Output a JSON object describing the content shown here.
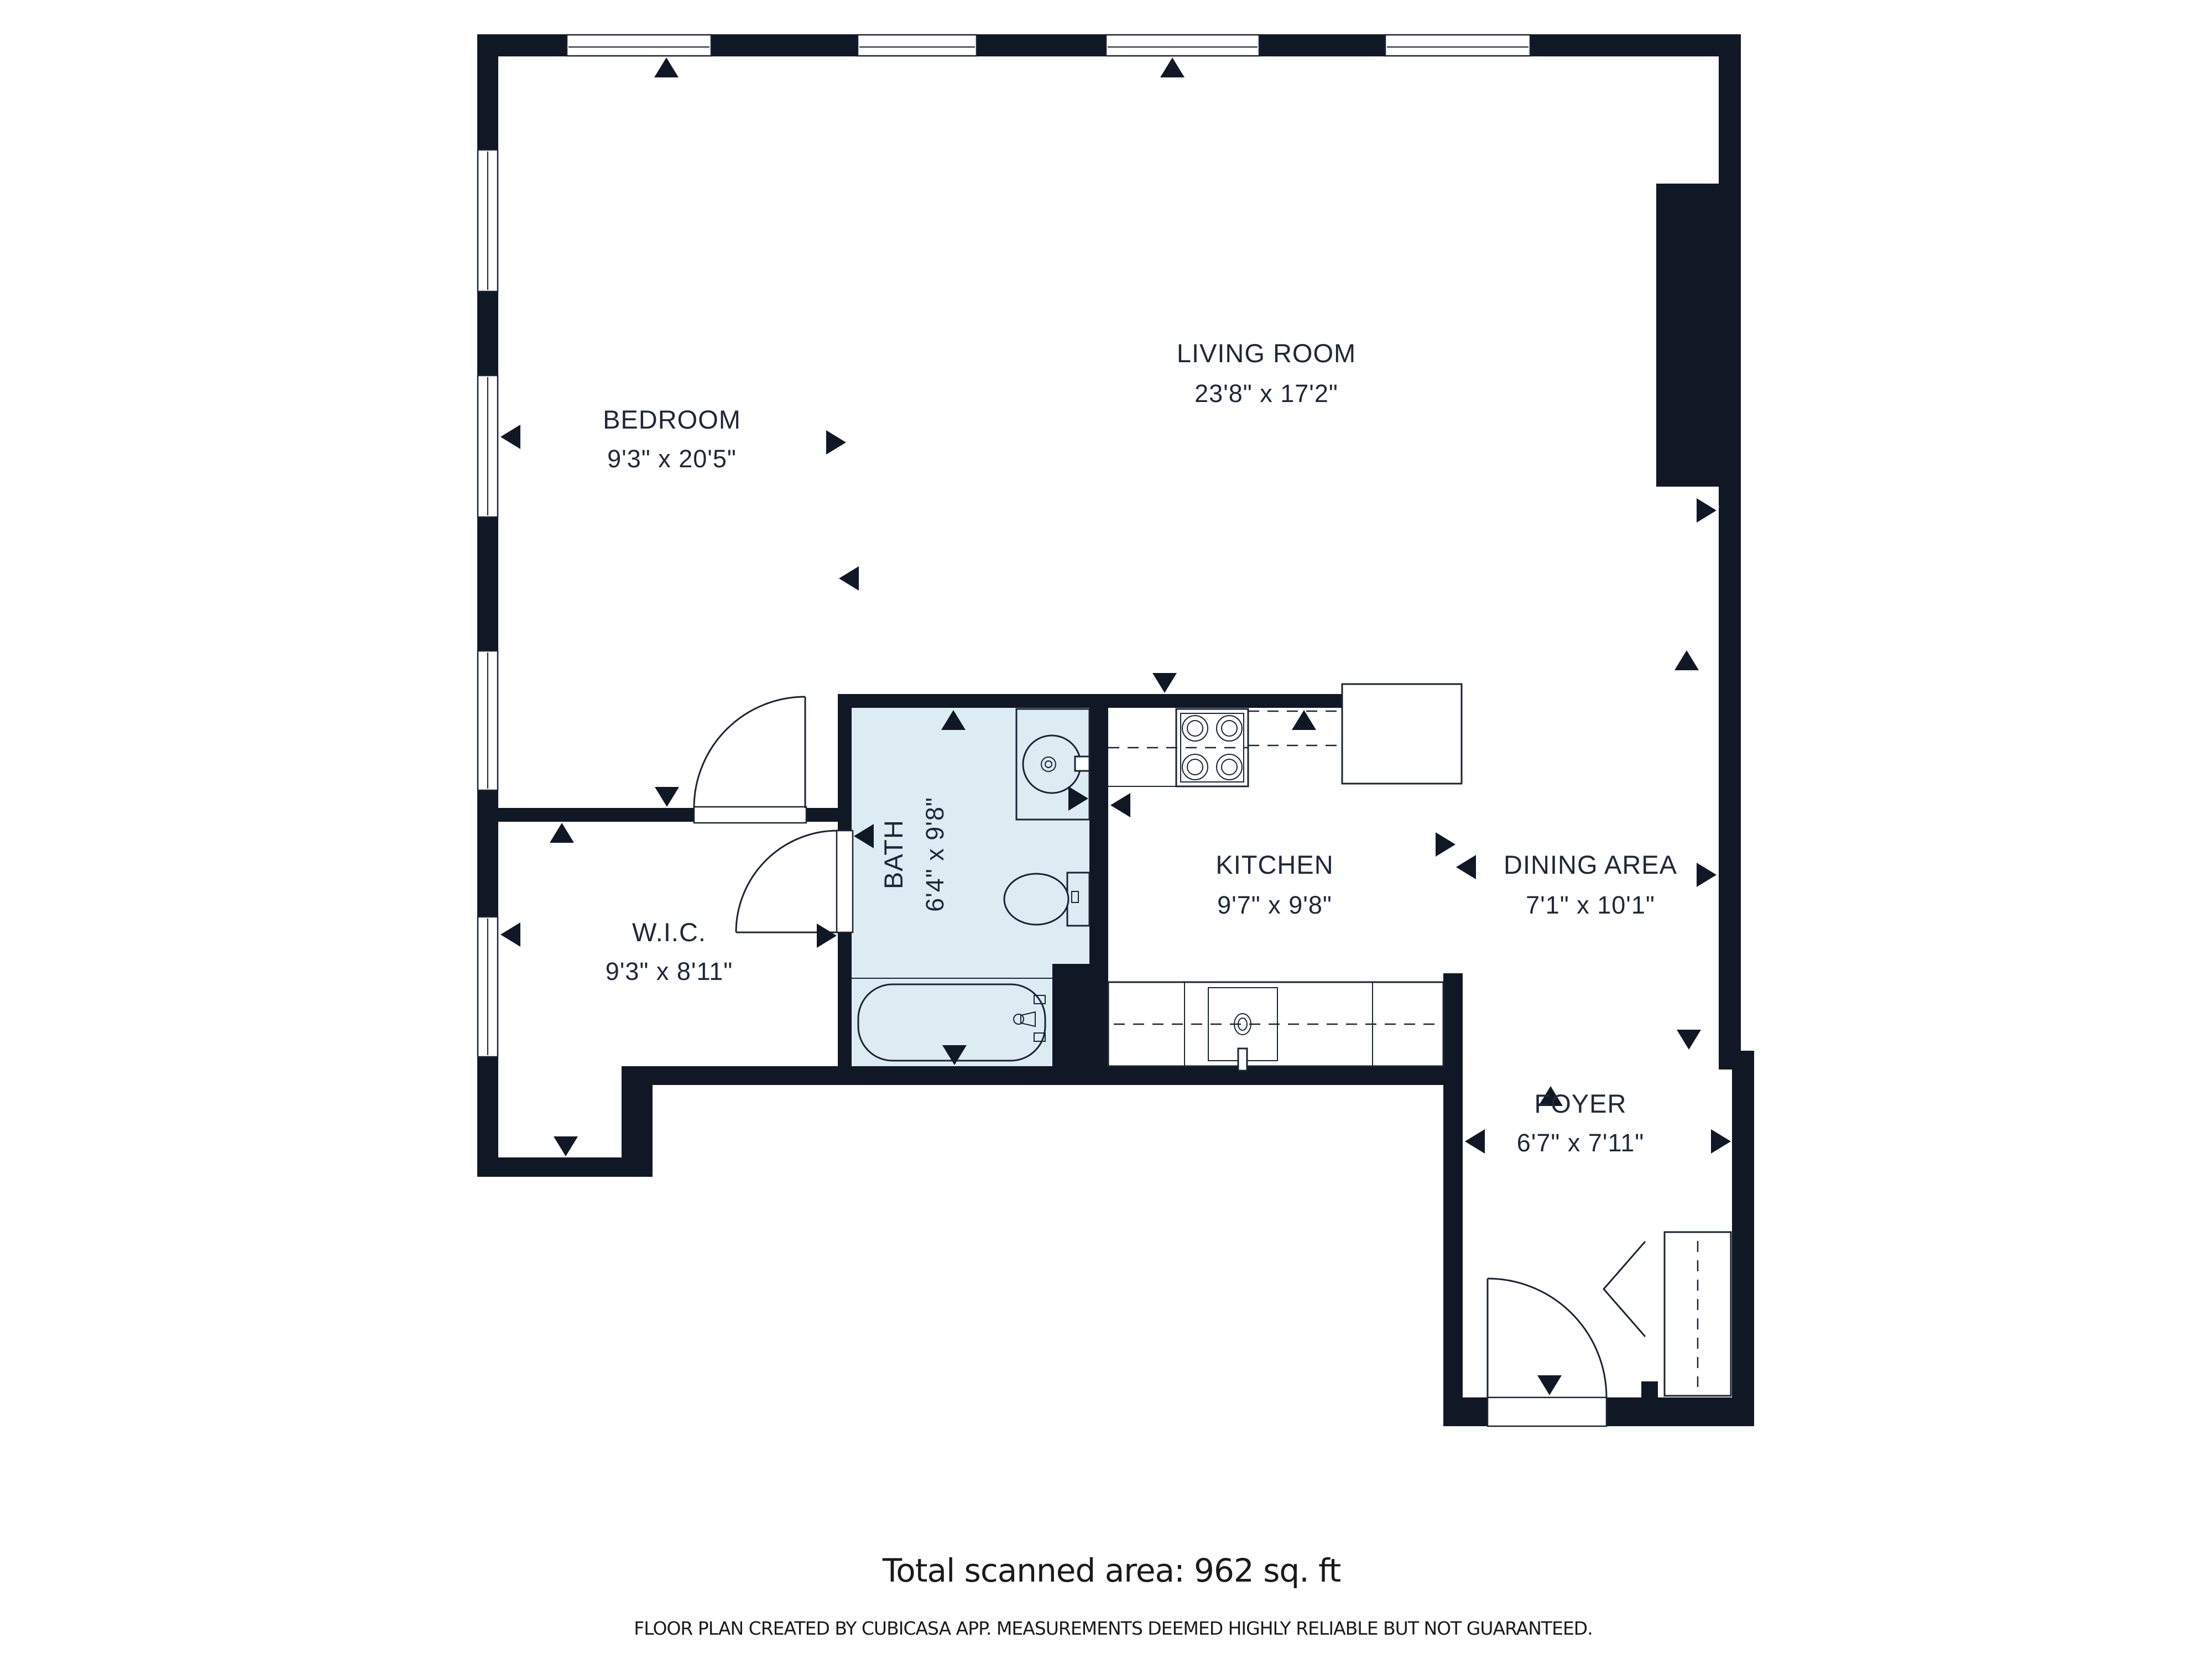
{
  "plan": {
    "rooms": {
      "living": {
        "name": "LIVING ROOM",
        "dims": "23'8\" x 17'2\""
      },
      "bedroom": {
        "name": "BEDROOM",
        "dims": "9'3\" x 20'5\""
      },
      "bath": {
        "name": "BATH",
        "dims": "6'4\" x 9'8\""
      },
      "kitchen": {
        "name": "KITCHEN",
        "dims": "9'7\" x 9'8\""
      },
      "dining": {
        "name": "DINING AREA",
        "dims": "7'1\" x 10'1\""
      },
      "wic": {
        "name": "W.I.C.",
        "dims": "9'3\" x 8'11\""
      },
      "foyer": {
        "name": "FOYER",
        "dims": "6'7\" x 7'11\""
      }
    },
    "summary": {
      "total_area_text": "Total scanned area: 962 sq. ft"
    },
    "disclaimer": "FLOOR PLAN CREATED BY CUBICASA APP. MEASUREMENTS DEEMED HIGHLY RELIABLE BUT NOT GUARANTEED.",
    "colors": {
      "wall": "#101826",
      "bath_floor": "#ddecf3",
      "line": "#1a2433",
      "label": "#1e2838",
      "footnote": "#1a1a1a"
    }
  }
}
